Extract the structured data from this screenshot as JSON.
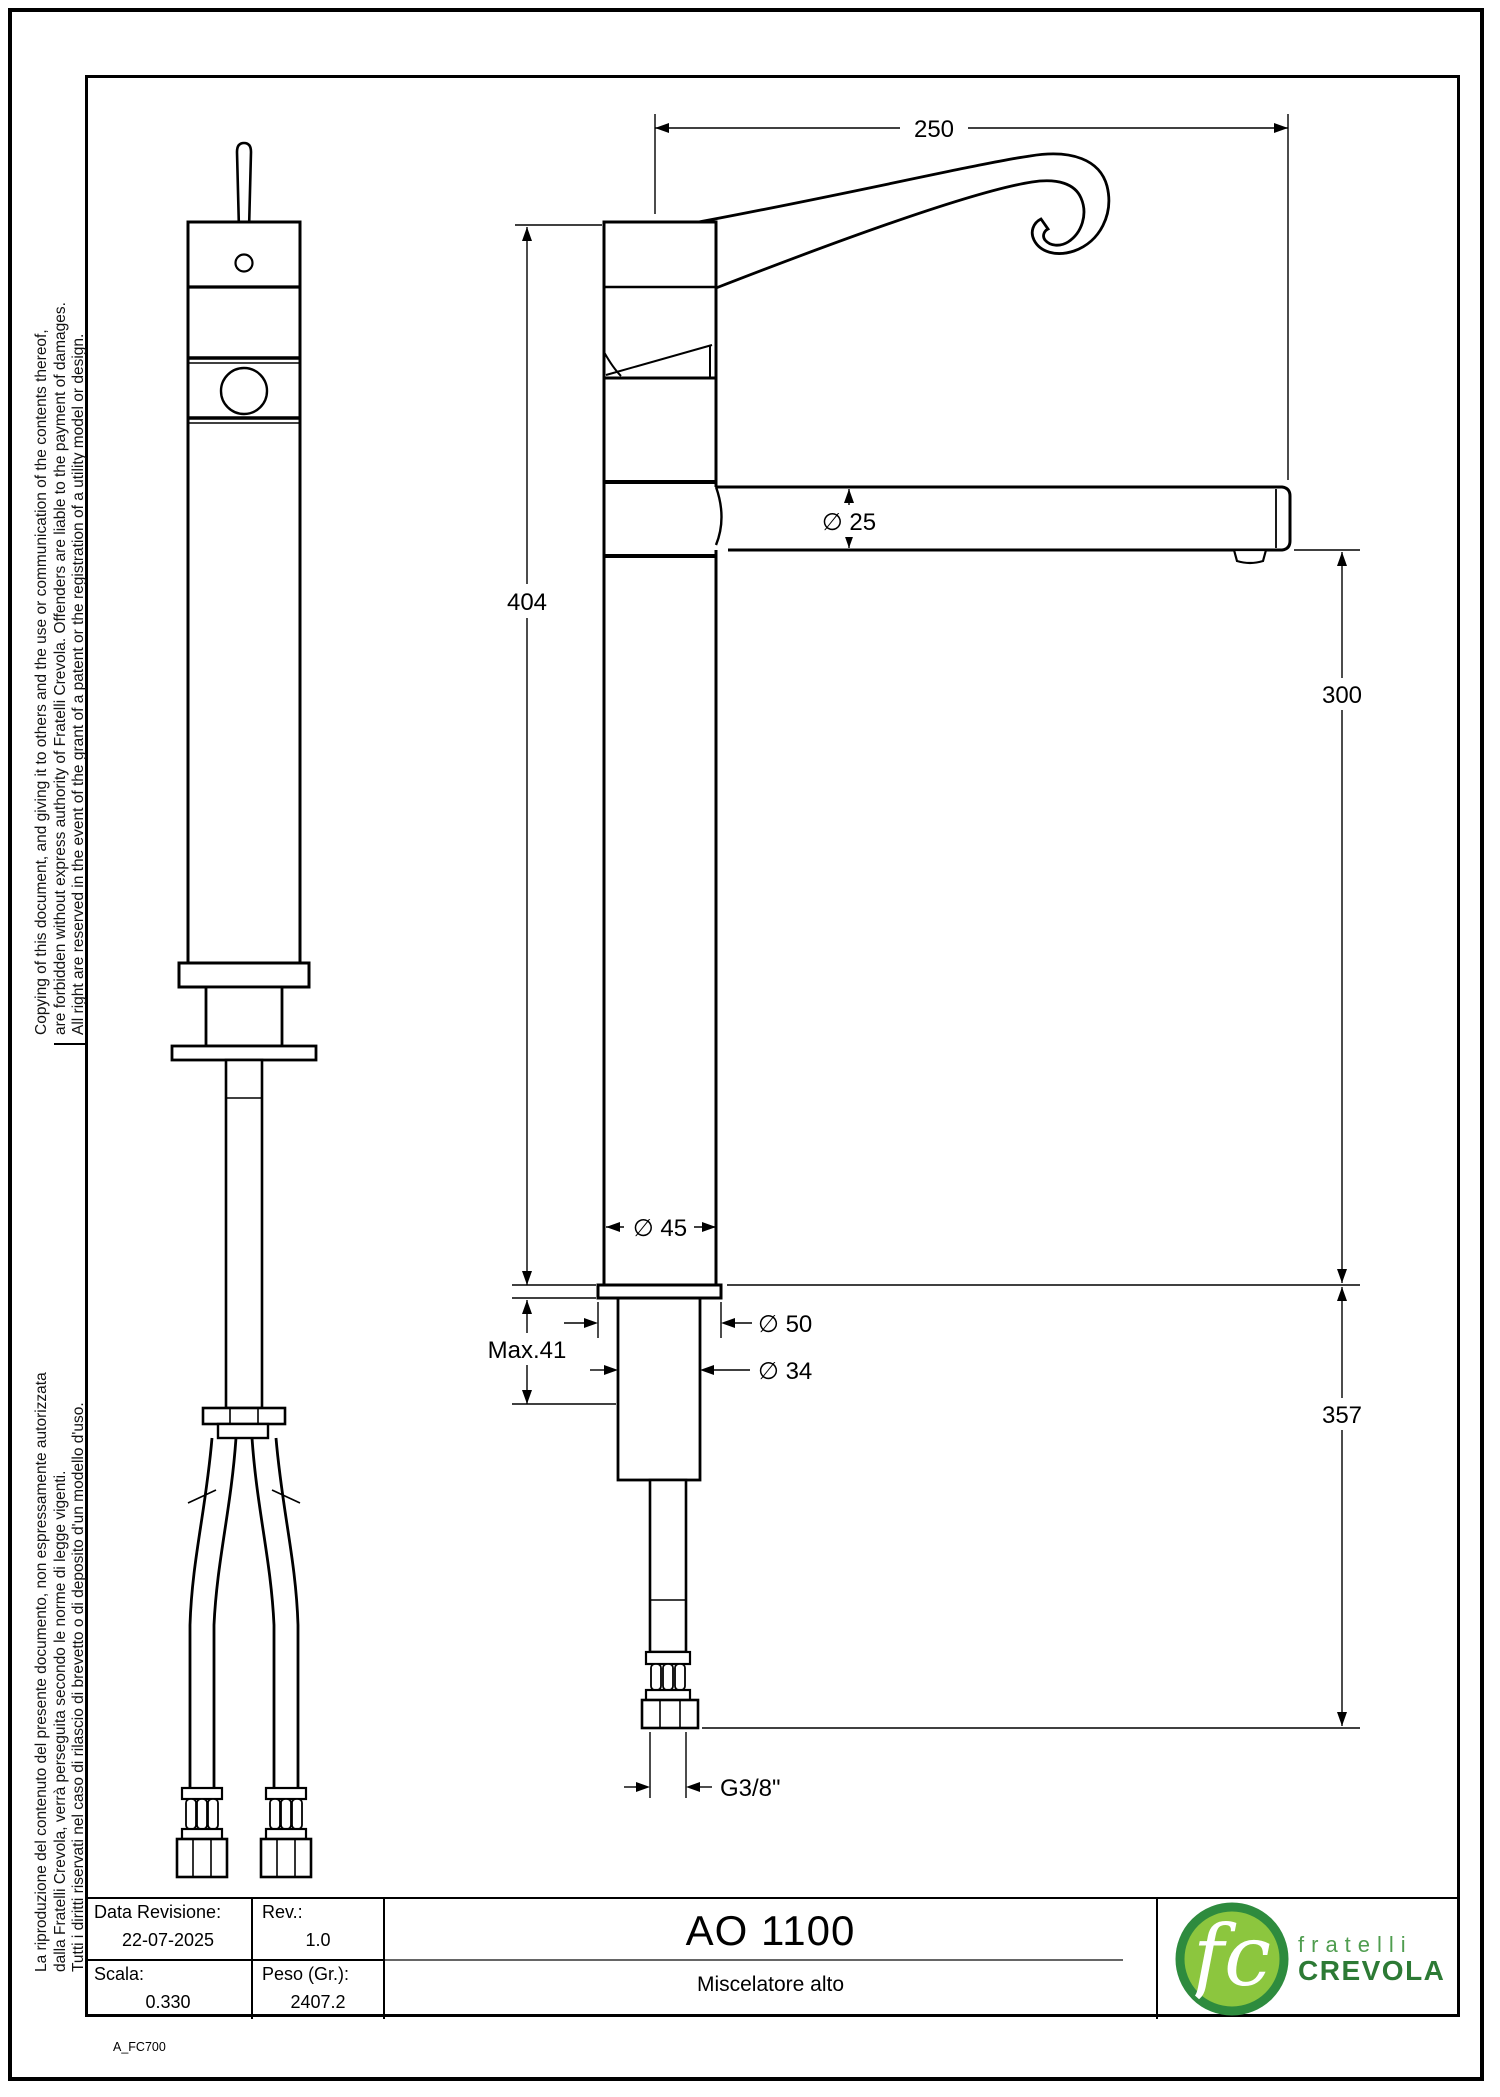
{
  "margin_notes": {
    "english": [
      "Copying of this document, and giving it to others and the use or communication of the contents thereof,",
      "are forbidden without express authority of Fratelli Crevola. Offenders are liable to the payment of damages.",
      "All right are reserved in the event of the grant of a patent or the registration of a utility model or design."
    ],
    "italian": [
      "La riproduzione del contenuto del presente documento, non espressamente autorizzata",
      "dalla Fratelli Crevola, verrà perseguita secondo le norme di legge vigenti.",
      "Tutti i diritti riservati nel caso di rilascio di brevetto o di deposito d'un modello d'uso."
    ]
  },
  "dimensions": {
    "spout_reach": "250",
    "spout_diameter": "∅ 25",
    "total_height": "404",
    "spout_height": "300",
    "body_diameter": "∅ 45",
    "max_thickness": "Max.41",
    "base_diameter": "∅ 50",
    "shank_diameter": "∅ 34",
    "under_length": "357",
    "thread": "G3/8\""
  },
  "title_block": {
    "date_label": "Data Revisione:",
    "date_value": "22-07-2025",
    "rev_label": "Rev.:",
    "rev_value": "1.0",
    "scale_label": "Scala:",
    "scale_value": "0.330",
    "weight_label": "Peso (Gr.):",
    "weight_value": "2407.2",
    "product_code": "AO 1100",
    "product_name": "Miscelatore alto"
  },
  "logo": {
    "monogram": "fc",
    "line1": "fratelli",
    "line2": "CREVOLA",
    "colors": {
      "ring": "#2e8b3e",
      "fill": "#8cc63e",
      "line1": "#4f9d4f",
      "line2": "#2d7a35"
    }
  },
  "doc_code": "A_FC700"
}
